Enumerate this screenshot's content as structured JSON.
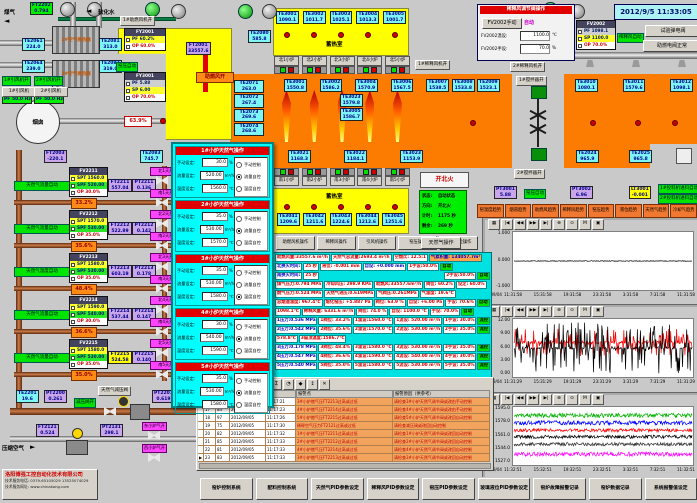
{
  "datetime": "2012/9/5 11:33:05",
  "trend_toolbar": [
    "▦",
    "|◀",
    "◀◀",
    "▶▶",
    "▶|",
    "⊕",
    "⊙",
    "M",
    "▣"
  ],
  "top_left": {
    "gas_label": "煤气",
    "water_label": "软化水",
    "ft2202_tag": "FT2202",
    "ft2202_val": "0.794",
    "hx1": "1#空气换热器",
    "hx2": "2#空气换热器",
    "te2061_tag": "TE2061",
    "te2061_val": "224.0",
    "te2064_tag": "TE2064",
    "te2064_val": "239.0",
    "te2081_tag": "TE2081",
    "te2081_val": "313.0",
    "te2082_tag": "TE2082",
    "te2082_val": "319.0",
    "fan1_on": "1#引风机开",
    "fan2_on": "2#引风机开",
    "fan1_name": "1#引风机",
    "fan1_hz": "PF 50.0 Hz",
    "fan2_name": "2#引风机",
    "fan2_hz": "PF 50.0 Hz",
    "chimney": "烟囱",
    "ft2003_tag": "FT2003",
    "ft2003_val": "-220.1",
    "te2083_tag": "TE2083",
    "te2083_val": "745.7",
    "blower_on": "1#助燃风机开",
    "fy2001_tag": "FY2001",
    "fy2001_pv": "PF 60.2%",
    "fy2001_op": "OP 60.0%",
    "ft2001_tag": "FT2001",
    "ft2001_val": "33557.6",
    "kiln_auto": "窑压自动",
    "fy3001_tag": "FY3001",
    "fy3001_pv": "PF 5.88",
    "fy3001_sp": "SP 6.00",
    "fy3001_op": "OP 70.0%",
    "damper_pct": "63.9%",
    "boost_open": "助燃风开",
    "te2080_tag": "TE2080",
    "te2080_val": "585.8"
  },
  "regen": {
    "label": "蓄热室",
    "south_label": "蓄热室",
    "north_te": [
      {
        "t": "TE3001",
        "v": "1090.1"
      },
      {
        "t": "TE3002",
        "v": "1011.7"
      },
      {
        "t": "TE3003",
        "v": "1025.1"
      },
      {
        "t": "TE3004",
        "v": "1013.3"
      },
      {
        "t": "TE3005",
        "v": "1001.7"
      }
    ],
    "north_burners": [
      "北1小炉",
      "北2小炉",
      "北3小炉",
      "北4小炉",
      "北5小炉"
    ],
    "south_burners": [
      "南1小炉",
      "南2小炉",
      "南3小炉",
      "南4小炉",
      "南5小炉"
    ],
    "south_te": [
      {
        "t": "TE3041",
        "v": "1209.6"
      },
      {
        "t": "TE3042",
        "v": "1211.6"
      },
      {
        "t": "TE3043",
        "v": "1224.6"
      },
      {
        "t": "TE3044",
        "v": "1212.6"
      },
      {
        "t": "TE3045",
        "v": "1251.6"
      }
    ]
  },
  "furnace": {
    "left_te": [
      {
        "t": "TE2071",
        "v": "263.0"
      },
      {
        "t": "TE2072",
        "v": "267.4"
      },
      {
        "t": "TE2073",
        "v": "269.6"
      },
      {
        "t": "TE2074",
        "v": "268.6"
      }
    ],
    "crown_te": [
      {
        "t": "TE3001",
        "v": "1550.8"
      },
      {
        "t": "TE3002",
        "v": "1586.2"
      },
      {
        "t": "TE3004",
        "v": "1570.9"
      },
      {
        "t": "TE3006",
        "v": "1567.5"
      },
      {
        "t": "TE3007",
        "v": "1538.5"
      }
    ],
    "te3023_tag": "TE3023",
    "te3023_val": "1579.8",
    "te3005_tag": "TE3005",
    "te3005_val": "1586.7",
    "te3008_tag": "TE3008",
    "te3008_val": "1533.8",
    "bottom_te": [
      {
        "t": "TE3021",
        "v": "1168.3"
      },
      {
        "t": "TE3022",
        "v": "1184.1"
      },
      {
        "t": "TE3023",
        "v": "1153.9"
      }
    ],
    "te2009_tag": "TE2009",
    "te2009_val": "1523.1",
    "right_te": [
      {
        "t": "TE3010",
        "v": "1080.1"
      },
      {
        "t": "TE3011",
        "v": "1579.6"
      },
      {
        "t": "TE3012",
        "v": "1098.1"
      }
    ],
    "right_bottom_te": [
      {
        "t": "TE2024",
        "v": "965.9"
      },
      {
        "t": "TE2025",
        "v": "965.8"
      }
    ],
    "stirrer1": "1#搅拌器开",
    "stirrer2": "2#搅拌器开"
  },
  "dilution": {
    "panel_title": "稀释风调节阀操作",
    "manual_btn": "FV2002手动",
    "auto_tag": "自动",
    "temp_label": "FV2002温设:",
    "temp_val": "1100.0",
    "temp_unit": "℃",
    "hand_label": "FV2002手设:",
    "hand_val": "70.0",
    "hand_unit": "%",
    "fan1_on": "1#稀释风机开",
    "fan2_on": "2#稀释风机开",
    "pct": "74.0%",
    "ft2002_tag": "FT2002",
    "ft2002_val": "6331.6",
    "fv2002_tag": "FV2002",
    "fv2002_pv": "PF 1098.1",
    "fv2002_sp": "SP 1100.0",
    "fv2002_op": "OP 70.0%",
    "auto_label": "稀释风自动",
    "btn_test": "试验弹电阀",
    "btn_normal": "助燃电阀正常"
  },
  "mid": {
    "fire_title": "开北火",
    "status": [
      {
        "k": "状态:",
        "v": "自动状态"
      },
      {
        "k": "方向:",
        "v": "开北火"
      },
      {
        "k": "计时:",
        "v": "1175 秒"
      },
      {
        "k": "剩余:",
        "v": "269 秒"
      }
    ],
    "gas_btn": "天然气操作",
    "pt3001_tag": "PT3001",
    "pt3001_val": "5.88",
    "kiln_auto": "窑压自动",
    "pt3002_tag": "PT3002",
    "pt3002_val": "6.96",
    "lt3001_tag": "LT3001",
    "lt3001_val": "-0.001",
    "feeder1": "1#投料机进料自动",
    "feeder2": "2#投料机进料自动",
    "trend_buttons": [
      "窑温度趋势",
      "烟道趋势",
      "助燃风趋势",
      "稀释风趋势",
      "窑压趋势",
      "液位趋势",
      "天然气趋势",
      "冷却气趋势"
    ],
    "op_buttons": [
      "助燃风机操作",
      "稀释风操作",
      "引风机操作",
      "窑压操作",
      "玻璃液位操作"
    ]
  },
  "gas_blocks": [
    {
      "auto": "天然气流量自动",
      "fv": "FV2211",
      "spt": "SPT 1560.0",
      "spf": "SPF 520.00",
      "op": "OP 30.0%",
      "ft_tag": "FT2211",
      "ft_val": "557.04",
      "pt_tag": "PT2211",
      "pt_val": "0.136",
      "pct": "33.2%",
      "v1": "北1天然气开",
      "v2": "南1天然气开"
    },
    {
      "auto": "天然气流量自动",
      "fv": "FV2212",
      "spt": "SPT 1570.0",
      "spf": "SPF 530.00",
      "op": "OP 35.0%",
      "ft_tag": "FT2212",
      "ft_val": "522.89",
      "pt_tag": "PT2212",
      "pt_val": "0.142",
      "pct": "35.6%",
      "v1": "北2天然气开",
      "v2": "南2天然气开"
    },
    {
      "auto": "天然气温度自动",
      "fv": "FV2213",
      "spt": "SPT 1580.0",
      "spf": "SPF 530.00",
      "op": "OP 35.0%",
      "ft_tag": "FT2213",
      "ft_val": "603.19",
      "pt_tag": "PT2213",
      "pt_val": "0.178",
      "pct": "48.4%",
      "v1": "北3天然气开",
      "v2": "南3天然气开"
    },
    {
      "auto": "天然气流量自动",
      "fv": "FV2214",
      "spt": "SPT 1590.0",
      "spf": "SPF 540.00",
      "op": "OP 30.0%",
      "ft_tag": "FT2214",
      "ft_val": "537.44",
      "pt_tag": "PT2214",
      "pt_val": "0.147",
      "pct": "36.6%",
      "v1": "北4天然气开",
      "v2": "南4天然气开"
    },
    {
      "auto": "天然气流量自动",
      "fv": "FV2215",
      "spt": "SPT 1580.0",
      "spf": "SPF 530.00",
      "op": "OP 35.0%",
      "ft_tag": "FT2215",
      "ft_val": "524.58",
      "pt_tag": "PT2215",
      "pt_val": "0.140",
      "pct": "35.0%",
      "v1": "北5天然气开",
      "v2": "南5天然气开",
      "ft_alarm": "true"
    }
  ],
  "gas_bottom": {
    "te2201_tag": "TE2201",
    "te2201_val": "19.6",
    "pt2200_tag": "PT2200",
    "pt2200_val": "0.261",
    "valve_open": "减压阀开",
    "reducer": "天然气减压阀",
    "pt2201_tag": "PT2201",
    "pt2201_val": "0.619",
    "air_label": "压缩空气",
    "ft2121_tag": "FT2121",
    "ft2121_val": "0.524",
    "pt2131_tag": "PT2131",
    "pt2131_val": "298.1",
    "valve_e": "东小炉气开",
    "valve_w": "西小炉气开"
  },
  "popup": {
    "manual_label": "手动设定:",
    "flow_label": "流量设定:",
    "temp_label": "温度设定:",
    "manual_unit": "%",
    "flow_unit": "m³/h",
    "temp_unit": "℃",
    "radio": [
      "手动控制",
      "流量自控",
      "温度自控"
    ],
    "sections": [
      {
        "title": "1#小炉天然气操作",
        "manual": "30.0",
        "flow": "520.00",
        "temp": "1560.0",
        "sel": 1
      },
      {
        "title": "2#小炉天然气操作",
        "manual": "35.0",
        "flow": "530.00",
        "temp": "1570.0",
        "sel": 1
      },
      {
        "title": "3#小炉天然气操作",
        "manual": "35.0",
        "flow": "530.00",
        "temp": "1580.0",
        "sel": 2
      },
      {
        "title": "4#小炉天然气操作",
        "manual": "30.0",
        "flow": "540.00",
        "temp": "1590.0",
        "sel": 1
      },
      {
        "title": "5#小炉天然气操作",
        "manual": "35.0",
        "flow": "530.00",
        "temp": "1580.0",
        "sel": 1
      }
    ]
  },
  "data_panel": {
    "rows": [
      [
        {
          "t": "助燃风量:33557.6 m³/h",
          "k": "r"
        },
        {
          "t": "天然气总流量:2693.4 m³/h",
          "k": "r"
        },
        {
          "t": "空燃比: 12.5:1",
          "k": "r"
        },
        {
          "t": "气累积量: 134057.7m³",
          "k": "o"
        }
      ],
      [
        {
          "t": "北换火时间:"
        },
        {
          "t": "25 秒",
          "k": "r"
        },
        {
          "t": "液位: -0.001 mm",
          "k": "r"
        },
        {
          "t": "自设: +0.000 mm"
        },
        {
          "t": "1手设:50.0%",
          "k": "r"
        },
        {
          "t": "自动",
          "k": "g"
        }
      ],
      [
        {
          "t": "南换火时间:"
        },
        {
          "t": "25 秒",
          "k": "r"
        },
        {
          "t": "",
          "k": "s"
        },
        {
          "t": "2手设:50.0%",
          "k": "r"
        },
        {
          "t": "自动",
          "k": "g"
        }
      ],
      [
        {
          "t": "煤气压力:0.794 MPa",
          "k": "r"
        },
        {
          "t": "冷却风压: 298.9 KPa",
          "k": "r"
        },
        {
          "t": "助燃风:33557.6m³/h",
          "k": "r"
        },
        {
          "t": "阀位: 60.2%",
          "k": "r"
        },
        {
          "t": "设定: 60.0%",
          "k": "r"
        }
      ],
      [
        {
          "t": "燃气压力:0.524 MPa",
          "k": "r"
        },
        {
          "t": "天然气进压:0.619MPa",
          "k": "r"
        },
        {
          "t": "气阀压:0.261MPa",
          "k": "r"
        },
        {
          "t": "气温度: 19.6℃",
          "k": "r"
        }
      ],
      [
        {
          "t": "总烟道温度: 967.4℃",
          "k": "r"
        },
        {
          "t": "熔化窑压: +5.887 Pa",
          "k": "r"
        },
        {
          "t": "阀位: 63.9 %",
          "k": "r"
        },
        {
          "t": "自设: +6.00 Pa",
          "k": "r"
        },
        {
          "t": "手设: 70.6%",
          "k": "r"
        },
        {
          "t": "自动",
          "k": "g"
        }
      ],
      [
        {
          "t": "1098.1℃",
          "k": "r"
        },
        {
          "t": "稀释风量: 6331.6 m³/h",
          "k": "r"
        },
        {
          "t": "阀位: 74.0 %",
          "k": "r"
        },
        {
          "t": "自设: 1100.0 ℃",
          "k": "r"
        },
        {
          "t": "手设: 70.0%",
          "k": "r"
        },
        {
          "t": "自动",
          "k": "g"
        }
      ],
      [
        {
          "t": "1压力:0.536 MPa"
        },
        {
          "t": "1阀位: 33.2%",
          "k": "r"
        },
        {
          "t": "1温设:1560.0 ℃",
          "k": "r"
        },
        {
          "t": "1流设: 520.00 m³/h",
          "k": "r"
        },
        {
          "t": "1手设: 30.0%",
          "k": "r"
        },
        {
          "t": "流控",
          "k": "g"
        }
      ],
      [
        {
          "t": "2压力:0.542 MPa"
        },
        {
          "t": "2阀位: 35.6%",
          "k": "r"
        },
        {
          "t": "2温设:1570.0 ℃",
          "k": "r"
        },
        {
          "t": "2流设: 530.00 m³/h",
          "k": "r"
        },
        {
          "t": "2手设: 35.0%",
          "k": "r"
        },
        {
          "t": "流控",
          "k": "g"
        }
      ],
      [
        {
          "t": "578.8℃",
          "k": "r"
        },
        {
          "t": "3碹顶温度:1586.7℃",
          "k": "r"
        }
      ],
      [
        {
          "t": "3压力:0.178 MPa"
        },
        {
          "t": "3阀位: 48.4%",
          "k": "r"
        },
        {
          "t": "3温设:1580.0 ℃",
          "k": "r"
        },
        {
          "t": "3流设: 530.00 m³/h",
          "k": "r"
        },
        {
          "t": "3手设: 35.0%",
          "k": "r"
        },
        {
          "t": "温控",
          "k": "g"
        }
      ],
      [
        {
          "t": "4压力:0.547 MPa"
        },
        {
          "t": "4阀位: 36.6%",
          "k": "r"
        },
        {
          "t": "4温设:1590.0 ℃",
          "k": "r"
        },
        {
          "t": "4流设: 540.00 m³/h",
          "k": "r"
        },
        {
          "t": "4手设: 30.0%",
          "k": "r"
        },
        {
          "t": "流控",
          "k": "g"
        }
      ],
      [
        {
          "t": "5压力:0.540 MPa"
        },
        {
          "t": "5阀位: 35.0%",
          "k": "r"
        },
        {
          "t": "5温设:1580.0 ℃",
          "k": "r"
        },
        {
          "t": "5流设: 530.00 m³/h",
          "k": "r"
        },
        {
          "t": "5手设: 35.0%",
          "k": "r"
        },
        {
          "t": "流控",
          "k": "g"
        }
      ]
    ]
  },
  "alarm": {
    "toolbar": [
      "≡",
      "?",
      "▤",
      "▥",
      "▦",
      "▧",
      "Σ",
      "◔",
      "◆",
      "↕",
      "✕"
    ],
    "col_point": "报警点",
    "col_reason": "报警原因（供参考）",
    "rows": [
      {
        "m": "",
        "n": "16",
        "c": "98",
        "d": "2012/09/05",
        "t": "11:17:21",
        "p": "3#小炉燃气压FT2213过高或过低",
        "r": "请检查3#小炉天然气调节阀或改由手动控制"
      },
      {
        "m": "",
        "n": "17",
        "c": "84",
        "d": "2012/09/05",
        "t": "11:17:23",
        "p": "4#小炉燃气压FT2214过高或过低",
        "r": "请检查4#小炉天然气调节阀或改由手动控制"
      },
      {
        "m": "",
        "n": "18",
        "c": "97",
        "d": "2012/09/05",
        "t": "11:17:26",
        "p": "5#小炉燃气压FT2215过高或过低",
        "r": "请检查5#小炉天然气调节阀或改回自动控制"
      },
      {
        "m": "",
        "n": "19",
        "c": "75",
        "d": "2012/09/05",
        "t": "11:17:30",
        "p": "稀释空气压力FT2121过高或过低",
        "r": "请检查减压阀或改回自动控制"
      },
      {
        "m": "",
        "n": "20",
        "c": "82",
        "d": "2012/09/05",
        "t": "11:17:32",
        "p": "1#小炉燃气压FT2211过高或过低",
        "r": "请检查1#小炉天然气调节阀或改回自动控制"
      },
      {
        "m": "",
        "n": "21",
        "c": "85",
        "d": "2012/09/05",
        "t": "11:17:33",
        "p": "2#小炉燃气压FT2212过高或过低",
        "r": "请检查2#小炉天然气调节阀或改回自动控制"
      },
      {
        "m": "",
        "n": "22",
        "c": "81",
        "d": "2012/09/05",
        "t": "11:17:33",
        "p": "4#小炉燃气压FT2214过高或过低",
        "r": "请检查4#小炉天然气调节阀或改回自动控制"
      },
      {
        "m": "▶",
        "n": "23",
        "c": "83",
        "d": "2012/09/05",
        "t": "11:17:33",
        "p": "3#小炉燃气压FT2213过高或过低",
        "r": "请检查3#小炉天然气调节阀或改回自动控制"
      }
    ]
  },
  "company": {
    "name": "洛阳博强工控自动化技术有限公司",
    "phone": "技术服务电话: 0379-65105029  13525074029",
    "web": "技术服务网址: www.chinakong.com"
  },
  "bottom_buttons": [
    "窑炉控制系统",
    "配料控制系统",
    "天然气PID参数设定",
    "稀释风PID参数设定",
    "窑压PID参数设定",
    "玻璃液位PID参数设定",
    "窑炉故障报警记录",
    "窑炉数据记录",
    "系统报警值设定"
  ],
  "chart_data": [
    {
      "type": "line",
      "name": "玻璃液位趋势",
      "date_label": "12/09/04",
      "ylim": [
        -1.05,
        1.05
      ],
      "yticks": [
        "1.000",
        "0.000",
        "-1.000"
      ],
      "xticks": [
        "11:31:58",
        "15:31:58",
        "19:31:58",
        "23:31:58",
        "3:31:58",
        "7:31:58",
        "11:31:58"
      ],
      "grid": false,
      "series": [
        {
          "name": "玻璃液位 LT3001",
          "color": "#000000",
          "base": 0.0,
          "noise": 0.012
        }
      ]
    },
    {
      "type": "line",
      "name": "熔化窑压趋势",
      "date_label": "12/09/04",
      "ylim": [
        0,
        12
      ],
      "yticks": [
        "12.00",
        "9.00",
        "6.00",
        "3.00",
        "0.00"
      ],
      "xticks": [
        "11:31:29",
        "15:31:29",
        "19:31:29",
        "23:31:29",
        "3:31:29",
        "7:31:29",
        "11:31:29"
      ],
      "grid": false,
      "series": [
        {
          "name": "窑压 PT3001",
          "color": "#ff0000",
          "base": 7.2,
          "noise": 0.3,
          "spike": 3.0,
          "spike_p": 0.35
        },
        {
          "name": "窑压 PT3002",
          "color": "#000000",
          "base": 6.0,
          "noise": 0.25,
          "spike": 5.5,
          "spike_p": 0.45
        }
      ]
    },
    {
      "type": "line",
      "name": "小炉温度趋势",
      "date_label": "12/09/04",
      "ylim": [
        1527,
        1595
      ],
      "yticks": [
        "1595.0",
        "1578.0",
        "1561.0",
        "1544.0",
        "1527.0"
      ],
      "xticks": [
        "11:32:51",
        "15:32:51",
        "19:32:51",
        "23:32:51",
        "3:32:51",
        "7:32:51",
        "11:32:51"
      ],
      "grid": false,
      "series": [
        {
          "name": "3#小炉温度",
          "color": "#00b000",
          "base": 1586,
          "noise": 2.6
        },
        {
          "name": "2#小炉温度",
          "color": "#0000ff",
          "base": 1577,
          "noise": 2.6
        },
        {
          "name": "4#小炉温度",
          "color": "#ff0000",
          "base": 1568,
          "noise": 2.0
        },
        {
          "name": "1#小炉温度",
          "color": "#000000",
          "base": 1560,
          "noise": 2.0
        },
        {
          "name": "5#小炉温度",
          "color": "#303030",
          "base": 1551,
          "noise": 2.0
        },
        {
          "name": "碹顶温度",
          "color": "#ff00ff",
          "base": 1539,
          "noise": 2.6
        }
      ]
    }
  ]
}
